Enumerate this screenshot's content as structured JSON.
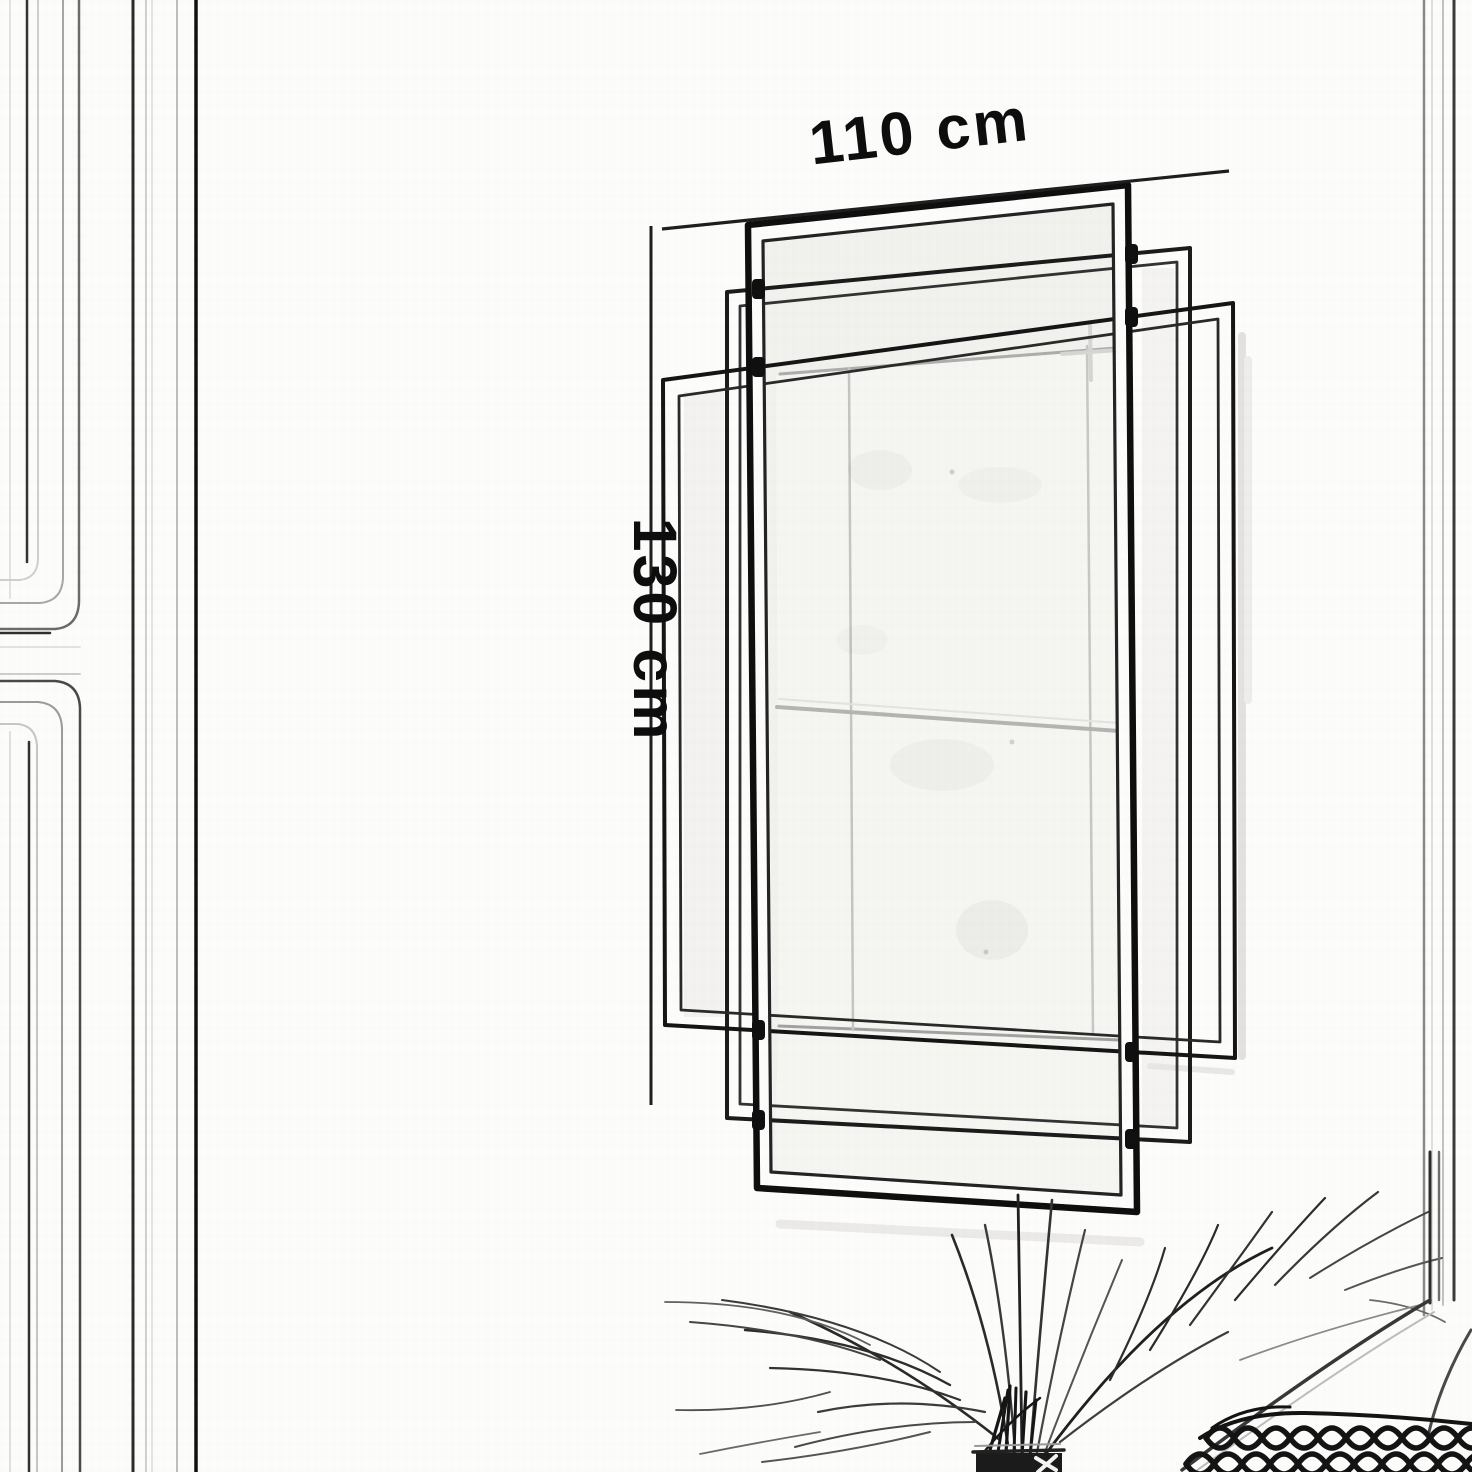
{
  "meta": {
    "scene": "hand-drawn dimension sketch",
    "subject": "art-deco rectangular wall mirror on paneled wall"
  },
  "annotations": {
    "width": {
      "label": "110 cm"
    },
    "height": {
      "label": "130 cm"
    }
  },
  "palette": {
    "paper": "#fcfcfb",
    "ink": "#141414",
    "ink_soft": "#3a3a3a",
    "pencil_light": "#c8c8c8",
    "glass": "#f5f5f2",
    "shadow": "#e8e7e4"
  }
}
